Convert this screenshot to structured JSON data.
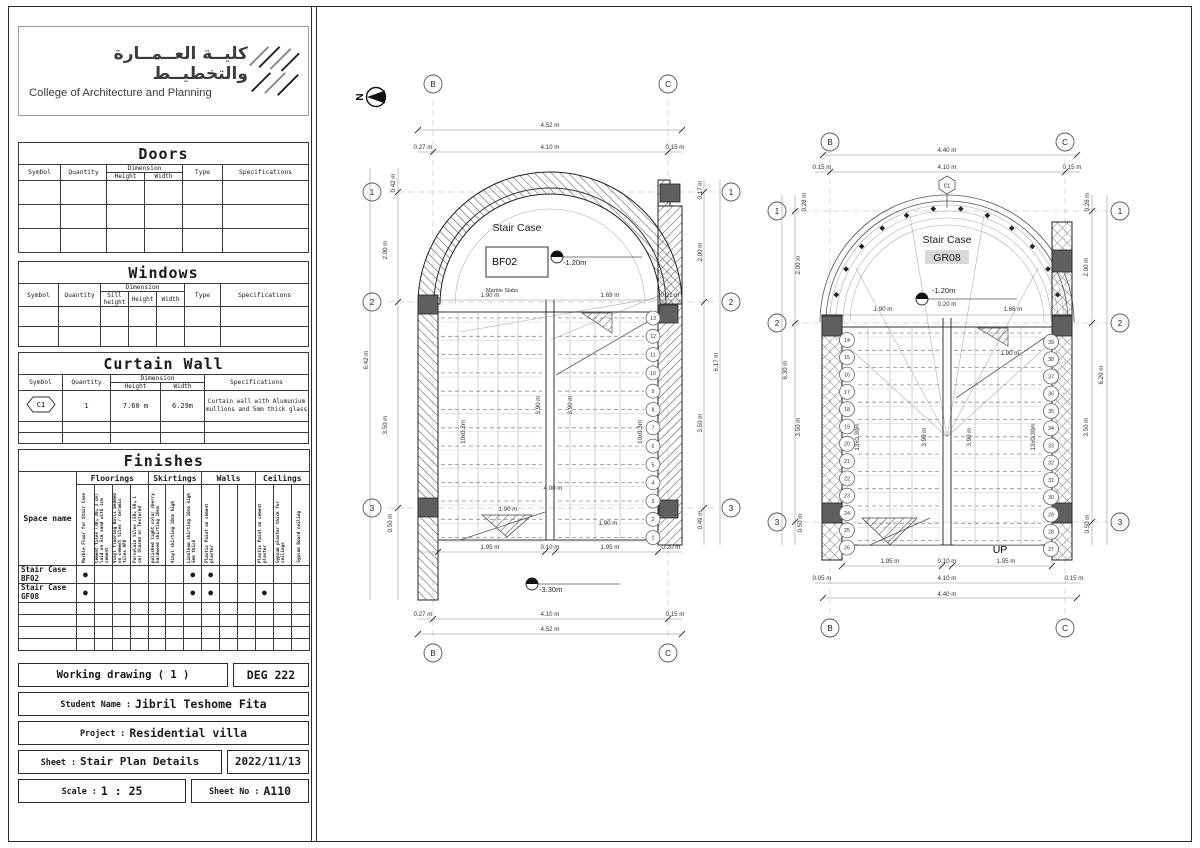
{
  "logo": {
    "title_ar": "كليــة العــمــارة والتخطيــط",
    "title_en": "College of Architecture and Planning"
  },
  "tables": {
    "doors": {
      "title": "Doors",
      "h_symbol": "Symbol",
      "h_quantity": "Quantity",
      "h_dimension": "Dimension",
      "h_height": "Height",
      "h_width": "Width",
      "h_type": "Type",
      "h_spec": "Specifications"
    },
    "windows": {
      "title": "Windows",
      "h_symbol": "Symbol",
      "h_quantity": "Quantity",
      "h_dimension": "Dimension",
      "h_sill": "Sill height",
      "h_height": "Height",
      "h_width": "Width",
      "h_type": "Type",
      "h_spec": "Specifications"
    },
    "curtain_wall": {
      "title": "Curtain Wall",
      "h_symbol": "Symbol",
      "h_quantity": "Quantity",
      "h_dimension": "Dimension",
      "h_height": "Height",
      "h_width": "Width",
      "h_spec": "Specifications",
      "row": {
        "symbol": "C1",
        "quantity": "1",
        "height": "7.60 m",
        "width": "6.29m",
        "spec": "Curtain wall with Alumunium mullions and 5mm thick glass"
      }
    },
    "finishes": {
      "title": "Finishes",
      "h_space": "Space name",
      "dot": "●",
      "groups": [
        {
          "label": "Floorings",
          "span": 4
        },
        {
          "label": "Skirtings",
          "span": 3
        },
        {
          "label": "Walls",
          "span": 3
        },
        {
          "label": "Ceilings",
          "span": 3
        }
      ],
      "columns": [
        "Marble Floor for Stair Case",
        "Cement tiles (30×30×3 cm) laid on 5cm sand with 1cm cement",
        "Vinyl flooring Rolls bedded on cement tiles / ceramic tiles APO",
        "Porcelain tiles (50×50×1 cm) Glazed or Textured",
        "polished light color cherry hardwood skirting 10cm",
        "Vinyl skirting 10cm high",
        "Linoleum skirting 10cm high 5mm thick",
        "Plastic Paint on cement plaster",
        "",
        "",
        "Plastic Paint on cement plaster",
        "Gypsum plaster thick for ceilings",
        "Gypsum Board ceiling"
      ],
      "rows": [
        {
          "name1": "Stair Case",
          "name2": "BF02",
          "dots": [
            0,
            6,
            7
          ]
        },
        {
          "name1": "Stair Case",
          "name2": "GF08",
          "dots": [
            0,
            6,
            7,
            10
          ]
        }
      ],
      "empty_rows": 4
    }
  },
  "title_block": {
    "working_drawing": "Working drawing  ( 1 )",
    "course": "DEG 222",
    "student_label": "Student Name :",
    "student_name": "Jibril Teshome Fita",
    "project_label": "Project :",
    "project_name": "Residential villa",
    "sheet_label": "Sheet :",
    "sheet_name": "Stair Plan Details",
    "date": "2022/11/13",
    "scale_label": "Scale :",
    "scale_value": "1 : 25",
    "sheet_no_label": "Sheet No :",
    "sheet_no": "A110"
  },
  "north_label": "N",
  "plans": {
    "left": {
      "title": "Stair Case",
      "tag": "BF02",
      "note": "Marble Slabs",
      "grid_cols": [
        {
          "label": "B",
          "x": 123
        },
        {
          "label": "C",
          "x": 358
        }
      ],
      "col_y": {
        "top": 84,
        "bottom": 653,
        "l1": 100,
        "l2": 640
      },
      "grid_rows": [
        {
          "label": "1",
          "y": 192
        },
        {
          "label": "2",
          "y": 302
        },
        {
          "label": "3",
          "y": 508
        }
      ],
      "row_x": {
        "left": 62,
        "right": 421,
        "l1": 78,
        "l2": 408
      },
      "steps": [
        {
          "x": 343,
          "y0": 318,
          "dy": 18.3,
          "r": 7,
          "nums": [
            13,
            12,
            11,
            10,
            9,
            8,
            7,
            6,
            5,
            4,
            3,
            2,
            1
          ]
        }
      ],
      "treads": [
        {
          "x1": 131,
          "x2": 232,
          "y0": 318,
          "dy": 18.3,
          "n": 13
        },
        {
          "x1": 248,
          "x2": 334,
          "y0": 318,
          "dy": 18.3,
          "n": 13
        }
      ],
      "levels": [
        {
          "x": 247,
          "y": 257,
          "len": 85,
          "tdx": 6,
          "tdy": 8,
          "text": "-1.20m"
        },
        {
          "x": 222,
          "y": 584,
          "len": 88,
          "tdx": 7,
          "tdy": 8,
          "text": "-3.30m"
        }
      ],
      "dims": [
        {
          "t": "4.52 m",
          "x": 240,
          "y": 127
        },
        {
          "t": "0.27 m",
          "x": 113,
          "y": 149
        },
        {
          "t": "4.10 m",
          "x": 240,
          "y": 149
        },
        {
          "t": "0.15 m",
          "x": 365,
          "y": 149
        },
        {
          "t": "1.90 m",
          "x": 180,
          "y": 297
        },
        {
          "t": "1.69 m",
          "x": 300,
          "y": 297
        },
        {
          "t": "0.21 m",
          "x": 360,
          "y": 297
        },
        {
          "t": "10x0.3m",
          "x": 155,
          "y": 432,
          "r": 1
        },
        {
          "t": "3.90 m",
          "x": 230,
          "y": 405,
          "r": 1
        },
        {
          "t": "3.90 m",
          "x": 262,
          "y": 405,
          "r": 1
        },
        {
          "t": "10x0.3m",
          "x": 332,
          "y": 432,
          "r": 1
        },
        {
          "t": "4.00 m",
          "x": 243,
          "y": 490
        },
        {
          "t": "1.90 m",
          "x": 198,
          "y": 511
        },
        {
          "t": "1.90 m",
          "x": 298,
          "y": 525
        },
        {
          "t": "1.95 m",
          "x": 180,
          "y": 549
        },
        {
          "t": "0.10 m",
          "x": 240,
          "y": 549
        },
        {
          "t": "1.95 m",
          "x": 300,
          "y": 549
        },
        {
          "t": "0.20 m",
          "x": 361,
          "y": 549
        },
        {
          "t": "0.27 m",
          "x": 113,
          "y": 616
        },
        {
          "t": "4.10 m",
          "x": 240,
          "y": 616
        },
        {
          "t": "0.15 m",
          "x": 365,
          "y": 616
        },
        {
          "t": "4.52 m",
          "x": 240,
          "y": 631
        },
        {
          "t": "0.42 m",
          "x": 85,
          "y": 183,
          "r": 1
        },
        {
          "t": "2.00 m",
          "x": 77,
          "y": 250,
          "r": 1
        },
        {
          "t": "6.42 m",
          "x": 58,
          "y": 360,
          "r": 1
        },
        {
          "t": "3.50 m",
          "x": 77,
          "y": 425,
          "r": 1
        },
        {
          "t": "0.50 m",
          "x": 82,
          "y": 523,
          "r": 1
        },
        {
          "t": "0.17 m",
          "x": 392,
          "y": 190,
          "r": 1
        },
        {
          "t": "2.00 m",
          "x": 392,
          "y": 252,
          "r": 1
        },
        {
          "t": "6.17 m",
          "x": 408,
          "y": 362,
          "r": 1
        },
        {
          "t": "3.50 m",
          "x": 392,
          "y": 423,
          "r": 1
        },
        {
          "t": "0.49 m",
          "x": 392,
          "y": 520,
          "r": 1
        }
      ]
    },
    "right": {
      "title": "Stair Case",
      "tag": "GR08",
      "up_label": "UP",
      "c1_tag": "C1",
      "grid_cols": [
        {
          "label": "B",
          "x": 520
        },
        {
          "label": "C",
          "x": 755
        }
      ],
      "col_y": {
        "top": 142,
        "bottom": 628,
        "l1": 158,
        "l2": 614
      },
      "grid_rows": [
        {
          "label": "1",
          "y": 211
        },
        {
          "label": "2",
          "y": 323
        },
        {
          "label": "3",
          "y": 522
        }
      ],
      "row_x": {
        "left": 467,
        "right": 810,
        "l1": 483,
        "l2": 797
      },
      "steps": [
        {
          "x": 537,
          "y0": 340,
          "dy": 17.3,
          "r": 7.5,
          "nums": [
            14,
            15,
            16,
            17,
            18,
            19,
            20,
            21,
            22,
            23,
            24,
            25,
            26
          ]
        },
        {
          "x": 741,
          "y0": 342,
          "dy": 17.25,
          "r": 7.5,
          "nums": [
            39,
            38,
            37,
            36,
            35,
            34,
            33,
            32,
            31,
            30,
            29,
            28,
            27
          ]
        }
      ],
      "treads": [
        {
          "x1": 548,
          "x2": 630,
          "y0": 333,
          "dy": 17.3,
          "n": 13
        },
        {
          "x1": 644,
          "x2": 731,
          "y0": 333,
          "dy": 17.3,
          "n": 13
        }
      ],
      "levels": [
        {
          "x": 612,
          "y": 299,
          "len": 95,
          "tdx": 10,
          "tdy": -6,
          "text": "-1.20m"
        }
      ],
      "mullions": {
        "cx": 637,
        "cy": 322,
        "r": 114,
        "n": 13
      },
      "dims": [
        {
          "t": "4.40 m",
          "x": 637,
          "y": 152
        },
        {
          "t": "0.15 m",
          "x": 512,
          "y": 169
        },
        {
          "t": "4.10 m",
          "x": 637,
          "y": 169
        },
        {
          "t": "0.15 m",
          "x": 762,
          "y": 169
        },
        {
          "t": "1.90 m",
          "x": 573,
          "y": 311
        },
        {
          "t": "0.20 m",
          "x": 637,
          "y": 306
        },
        {
          "t": "1.66 m",
          "x": 703,
          "y": 311
        },
        {
          "t": "1.90 m",
          "x": 700,
          "y": 355
        },
        {
          "t": "13x0.30m",
          "x": 549,
          "y": 437,
          "r": 1
        },
        {
          "t": "3.90 m",
          "x": 616,
          "y": 437,
          "r": 1
        },
        {
          "t": "3.90 m",
          "x": 661,
          "y": 437,
          "r": 1
        },
        {
          "t": "13x0.30m",
          "x": 725,
          "y": 437,
          "r": 1
        },
        {
          "t": "1.95 m",
          "x": 580,
          "y": 563
        },
        {
          "t": "0.10 m",
          "x": 637,
          "y": 563
        },
        {
          "t": "1.95 m",
          "x": 696,
          "y": 563
        },
        {
          "t": "0.05 m",
          "x": 512,
          "y": 580
        },
        {
          "t": "4.10 m",
          "x": 637,
          "y": 580
        },
        {
          "t": "0.15 m",
          "x": 764,
          "y": 580
        },
        {
          "t": "4.40 m",
          "x": 637,
          "y": 596
        },
        {
          "t": "0.28 m",
          "x": 496,
          "y": 202,
          "r": 1
        },
        {
          "t": "2.00 m",
          "x": 490,
          "y": 265,
          "r": 1
        },
        {
          "t": "6.30 m",
          "x": 477,
          "y": 370,
          "r": 1
        },
        {
          "t": "3.50 m",
          "x": 490,
          "y": 427,
          "r": 1
        },
        {
          "t": "0.50 m",
          "x": 492,
          "y": 523,
          "r": 1
        },
        {
          "t": "0.28 m",
          "x": 779,
          "y": 202,
          "r": 1
        },
        {
          "t": "2.00 m",
          "x": 778,
          "y": 267,
          "r": 1
        },
        {
          "t": "6.20 m",
          "x": 793,
          "y": 375,
          "r": 1
        },
        {
          "t": "3.50 m",
          "x": 778,
          "y": 427,
          "r": 1
        },
        {
          "t": "0.50 m",
          "x": 779,
          "y": 524,
          "r": 1
        }
      ]
    }
  }
}
